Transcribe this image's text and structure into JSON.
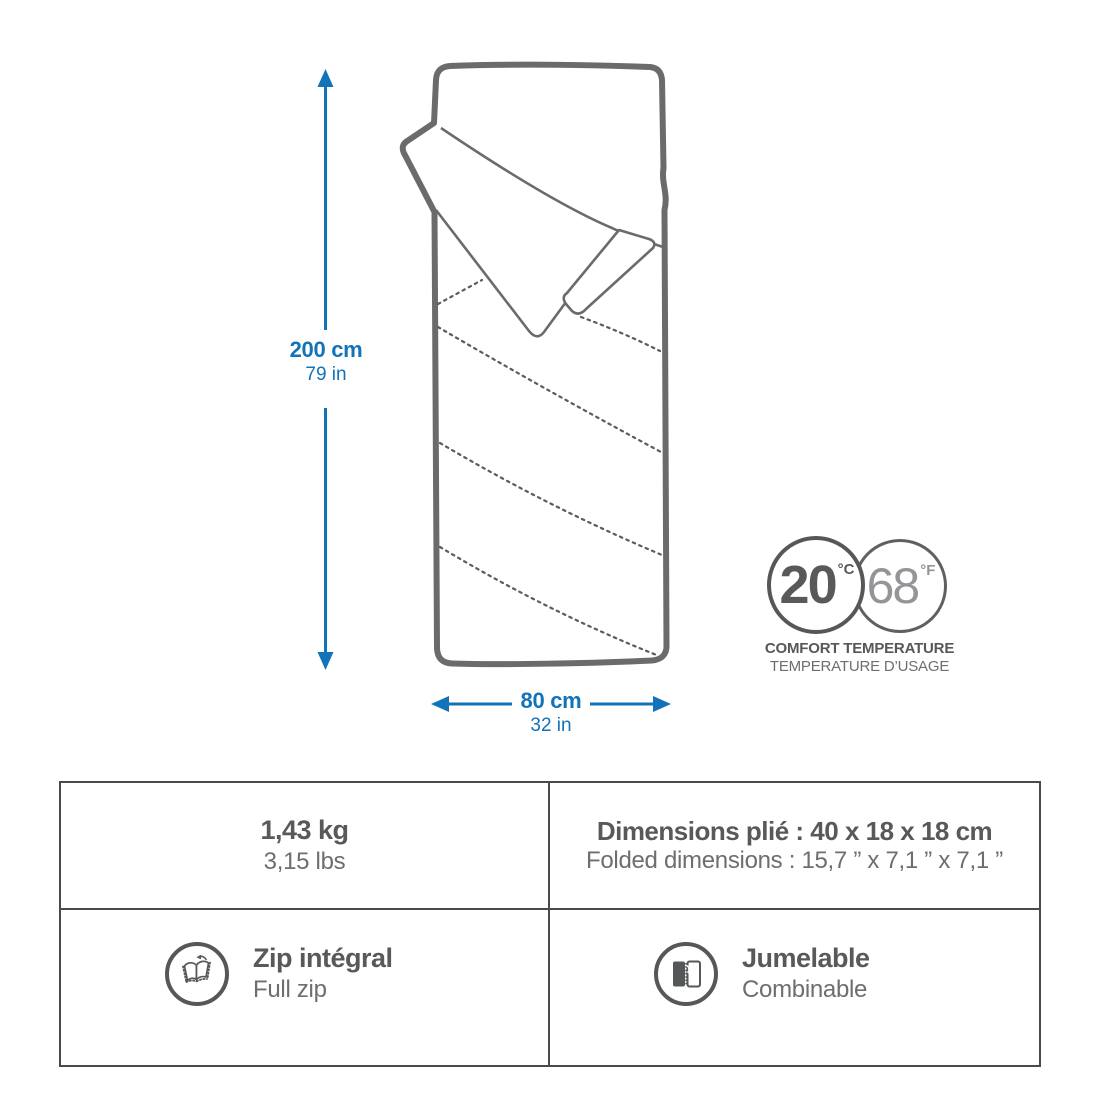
{
  "colors": {
    "accent_blue": "#1273b8",
    "line_gray": "#6b6b6b",
    "text_dark": "#58595b",
    "text_mid": "#6d6e70",
    "table_border": "#4a4a4a"
  },
  "diagram": {
    "length": {
      "metric": "200 cm",
      "imperial": "79 in"
    },
    "width": {
      "metric": "80 cm",
      "imperial": "32 in"
    },
    "comfort_temperature": {
      "celsius": "20",
      "celsius_unit": "°C",
      "fahrenheit": "68",
      "fahrenheit_unit": "°F",
      "caption_en": "COMFORT TEMPERATURE",
      "caption_fr": "TEMPERATURE D’USAGE"
    }
  },
  "specs": {
    "weight": {
      "metric": "1,43 kg",
      "imperial": "3,15 lbs"
    },
    "folded_dimensions": {
      "fr": "Dimensions plié : 40 x 18 x 18 cm",
      "en": "Folded dimensions : 15,7 ” x 7,1 ” x 7,1 ”"
    },
    "zip": {
      "fr": "Zip intégral",
      "en": "Full zip",
      "icon": "full-zip-icon"
    },
    "pairing": {
      "fr": "Jumelable",
      "en": "Combinable",
      "icon": "zip-together-icon"
    }
  }
}
